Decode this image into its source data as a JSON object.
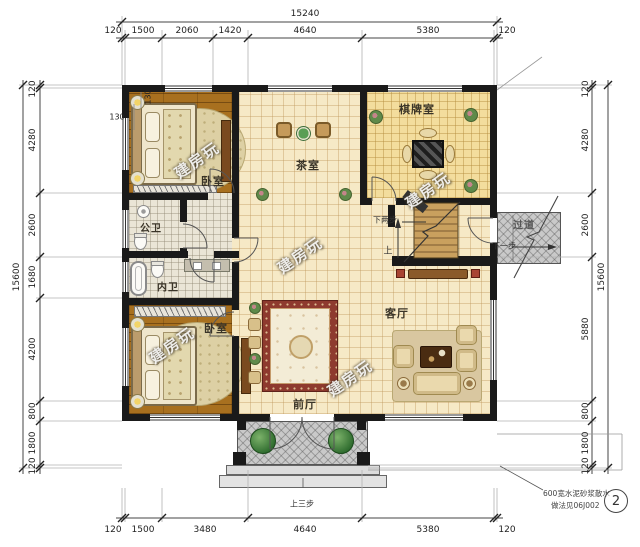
{
  "plan": {
    "rooms": {
      "bedroom1": "卧室",
      "bedroom2": "卧室",
      "tea_room": "茶室",
      "game_room": "棋牌室",
      "living_room": "客厅",
      "front_hall": "前厅",
      "public_bath": "公卫",
      "ensuite_bath": "内卫",
      "corridor": "过道"
    },
    "stairs": {
      "down_two": "下两步",
      "up": "上",
      "down_one": "下一步",
      "up_three": "上三步"
    },
    "notes": {
      "apron_line1": "600宽水泥砂浆散水",
      "apron_line2": "做法见06J002",
      "detail_no": "2"
    },
    "watermark": "建房玩"
  },
  "dimensions": {
    "top": {
      "total": "15240",
      "segments": [
        "120",
        "1500",
        "2060",
        "1420",
        "4640",
        "5380",
        "120"
      ]
    },
    "bottom": {
      "segments": [
        "120",
        "1500",
        "3480",
        "4640",
        "5380",
        "120"
      ]
    },
    "left": {
      "total": "15600",
      "segments": [
        "120",
        "4280",
        "2600",
        "1680",
        "4200",
        "800",
        "1800",
        "120"
      ]
    },
    "right": {
      "total": "15600",
      "segments": [
        "120",
        "4280",
        "2600",
        "5880",
        "800",
        "1800",
        "120"
      ]
    },
    "offsets": {
      "wall_v": "130",
      "wall_h": "130"
    }
  }
}
